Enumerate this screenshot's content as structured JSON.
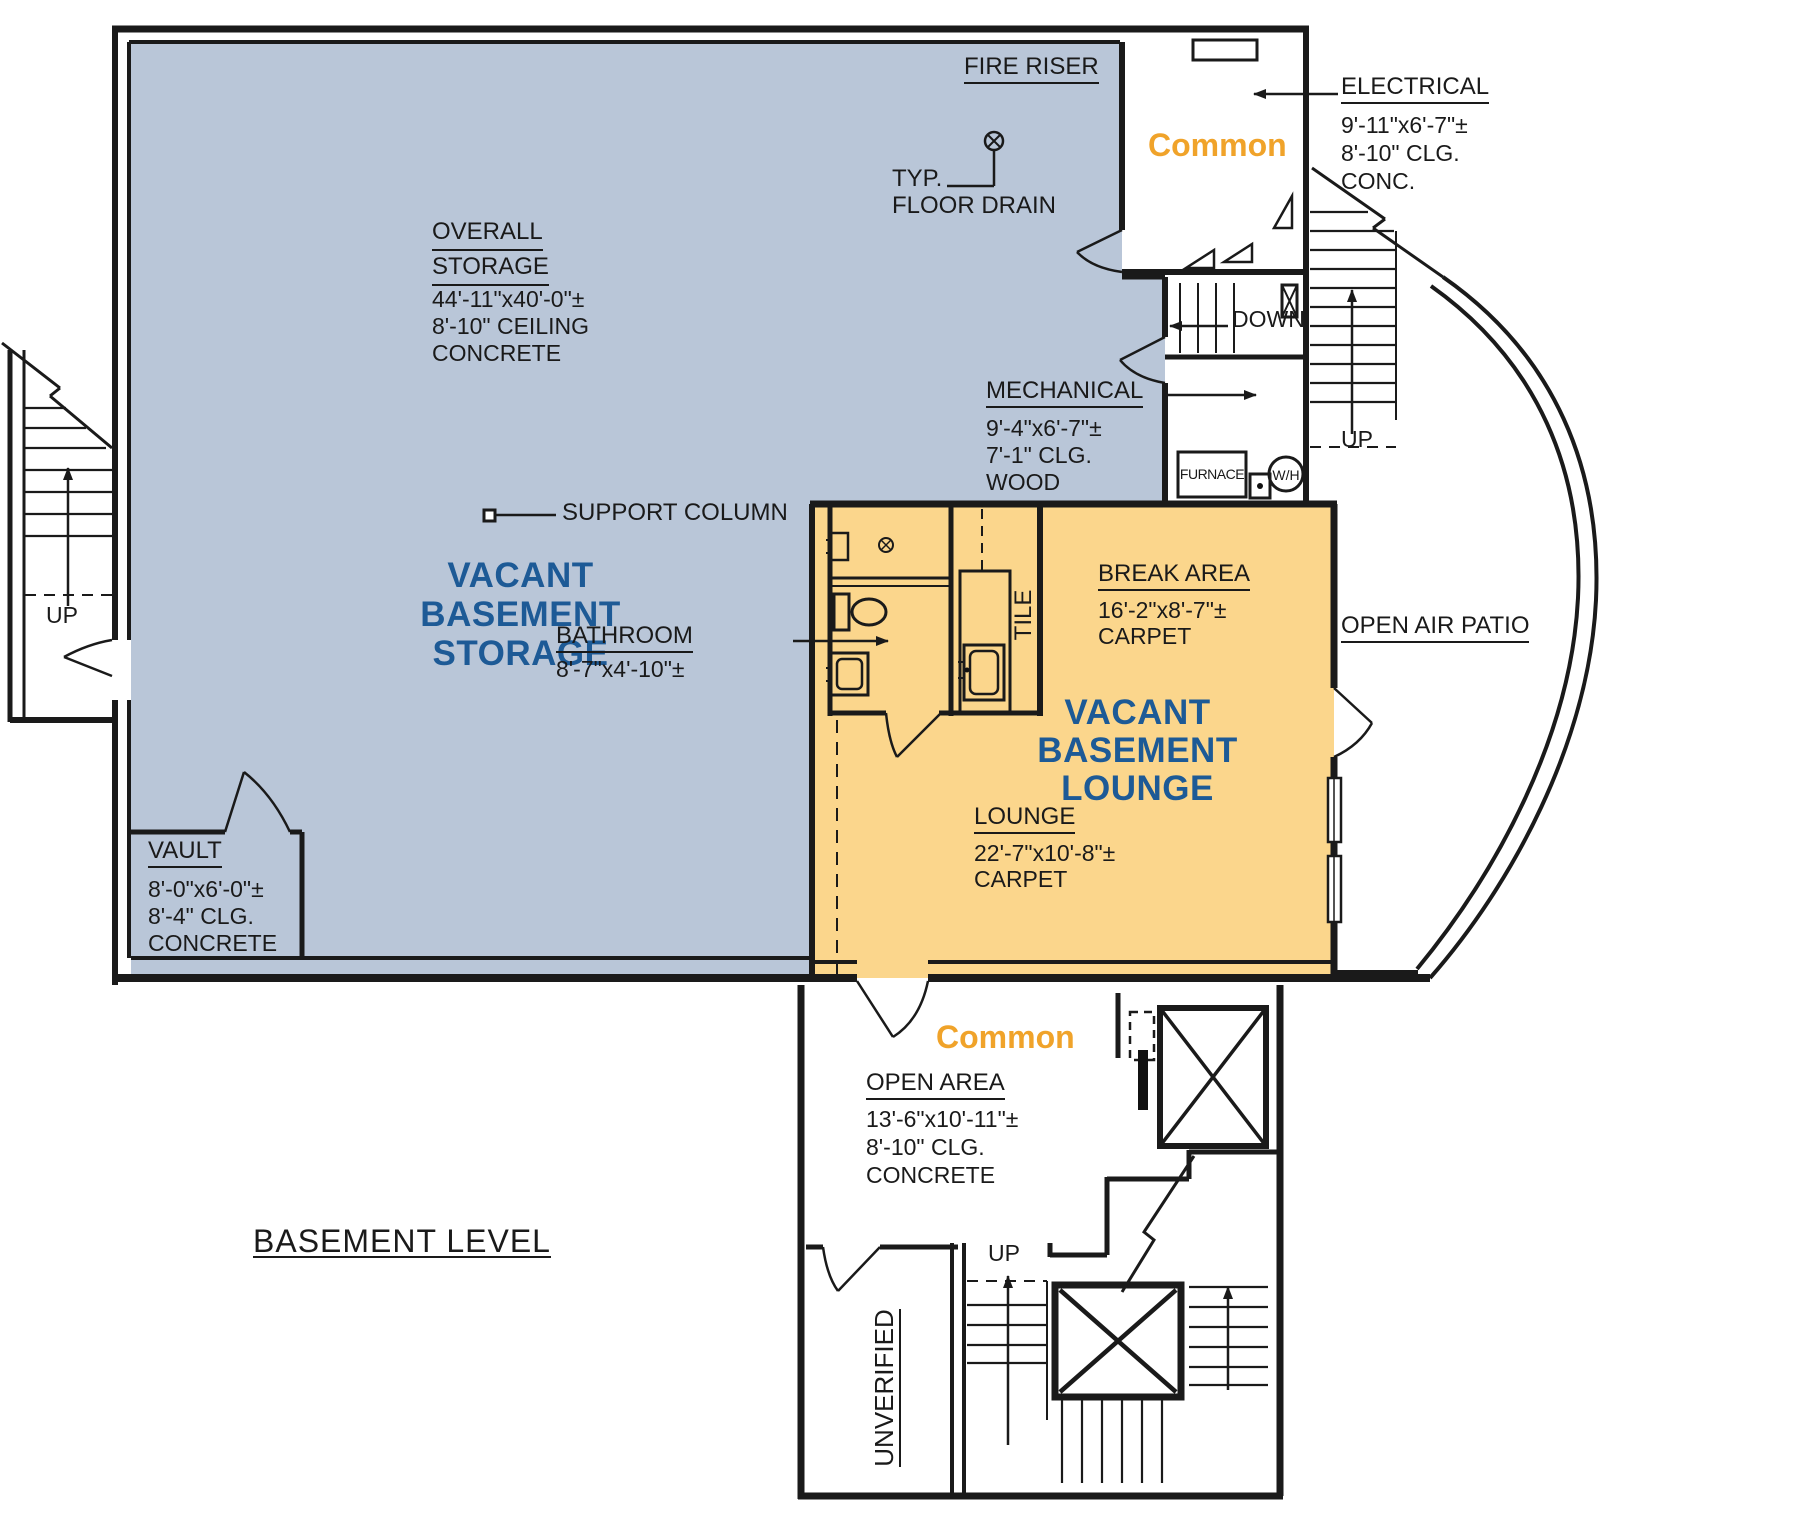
{
  "plan_title": "BASEMENT LEVEL",
  "colors": {
    "storage_fill": "#b9c6d8",
    "lounge_fill": "#fbd68c",
    "room_name_blue": "#1d5a96",
    "common_orange": "#f0a32a",
    "line": "#1a1a1a"
  },
  "areas": {
    "storage": {
      "name_lines": [
        "VACANT",
        "BASEMENT",
        "STORAGE"
      ],
      "label_line1": "OVERALL",
      "label_line2": "STORAGE",
      "dims": [
        "44'-11\"x40'-0\"±",
        "8'-10\" CEILING",
        "CONCRETE"
      ]
    },
    "lounge": {
      "name_lines": [
        "VACANT",
        "BASEMENT",
        "LOUNGE"
      ],
      "label": "LOUNGE",
      "dims": [
        "22'-7\"x10'-8\"±",
        "CARPET"
      ]
    },
    "break_area": {
      "label": "BREAK AREA",
      "dims": [
        "16'-2\"x8'-7\"±",
        "CARPET"
      ]
    },
    "bathroom": {
      "label": "BATHROOM",
      "dims": [
        "8'-7\"x4'-10\"±"
      ]
    },
    "electrical": {
      "label": "ELECTRICAL",
      "dims": [
        "9'-11\"x6'-7\"±",
        "8'-10\" CLG.",
        "CONC."
      ]
    },
    "mechanical": {
      "label": "MECHANICAL",
      "dims": [
        "9'-4\"x6'-7\"±",
        "7'-1\" CLG.",
        "WOOD"
      ]
    },
    "vault": {
      "label": "VAULT",
      "dims": [
        "8'-0\"x6'-0\"±",
        "8'-4\" CLG.",
        "CONCRETE"
      ]
    },
    "open_area": {
      "label": "OPEN AREA",
      "dims": [
        "13'-6\"x10'-11\"±",
        "8'-10\" CLG.",
        "CONCRETE"
      ]
    },
    "open_air_patio": {
      "label": "OPEN AIR PATIO"
    },
    "unverified": {
      "label": "UNVERIFIED"
    }
  },
  "annotations": {
    "fire_riser": "FIRE RISER",
    "typ": "TYP.",
    "floor_drain": "FLOOR DRAIN",
    "support_column": "SUPPORT COLUMN",
    "tile": "TILE",
    "common": "Common",
    "down": "DOWN",
    "up": "UP",
    "furnace": "FURNACE",
    "water_heater": "W/H"
  }
}
